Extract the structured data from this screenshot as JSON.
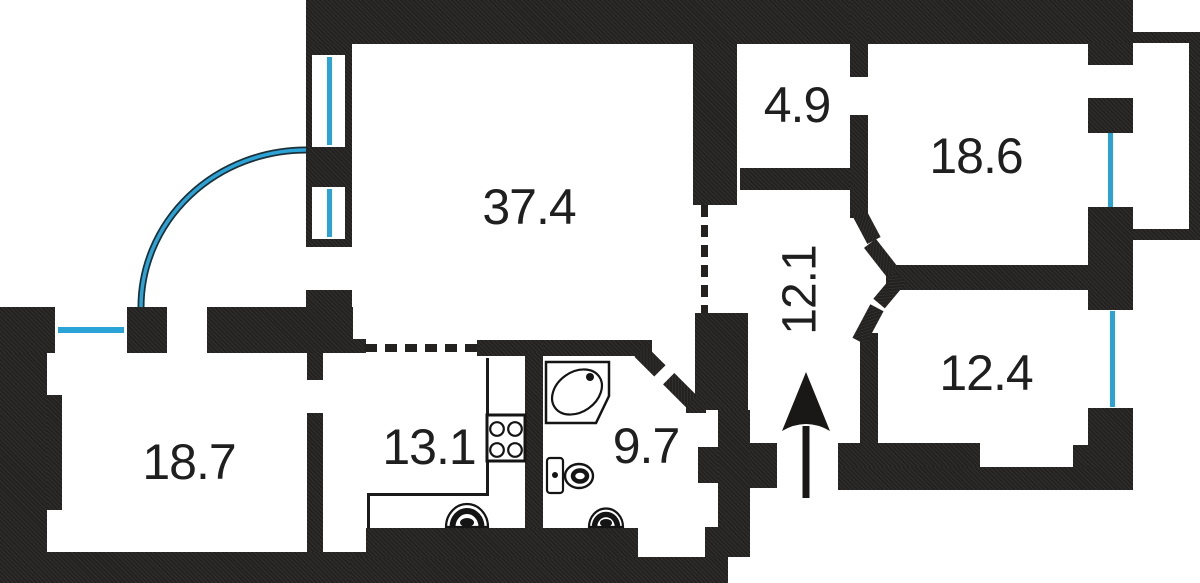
{
  "title": "Apartment floor plan",
  "colors": {
    "wall": "#242220",
    "window_blue": "#2ba3d6",
    "label": "#1f1f1f",
    "background": "#ffffff"
  },
  "rooms": {
    "living": {
      "label": "37.4"
    },
    "closet": {
      "label": "4.9"
    },
    "bedroom_top_right": {
      "label": "18.6"
    },
    "hallway": {
      "label": "12.1"
    },
    "bedroom_right": {
      "label": "12.4"
    },
    "bedroom_left": {
      "label": "18.7"
    },
    "kitchen": {
      "label": "13.1"
    },
    "bathroom": {
      "label": "9.7"
    }
  },
  "icons": {
    "bathtub": "corner bathtub with oval basin and drain dot",
    "toilet": "toilet with tank",
    "kitchen_sink": "half-round sink",
    "bathroom_sink": "half-round sink",
    "stove": "four-burner stove",
    "entrance_arrow": "up arrow through entrance door",
    "door_swing_arc": "quarter-circle blue door swing",
    "window": "blue line in wall opening"
  }
}
